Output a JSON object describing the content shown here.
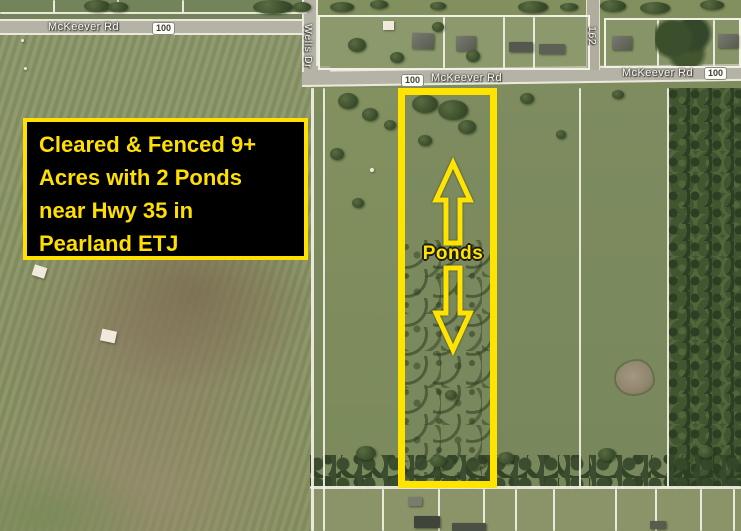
{
  "callout": {
    "line1": "Cleared & Fenced 9+",
    "line2": "Acres with 2 Ponds",
    "line3": "near Hwy 35 in",
    "line4": "Pearland ETJ"
  },
  "roads": {
    "mckeever_west": "McKeever Rd",
    "shield_west": "100",
    "wells_dr": "Wells Dr",
    "shield_mid": "100",
    "mckeever_mid": "McKeever Rd",
    "route_162": "162",
    "mckeever_east": "McKeever Rd",
    "shield_east": "100"
  },
  "property": {
    "ponds_label": "Ponds"
  },
  "colors": {
    "annotation_yellow": "#ffe400",
    "callout_background": "#000000",
    "field_green": "#87926a",
    "road_gray": "#b5b3a6"
  }
}
